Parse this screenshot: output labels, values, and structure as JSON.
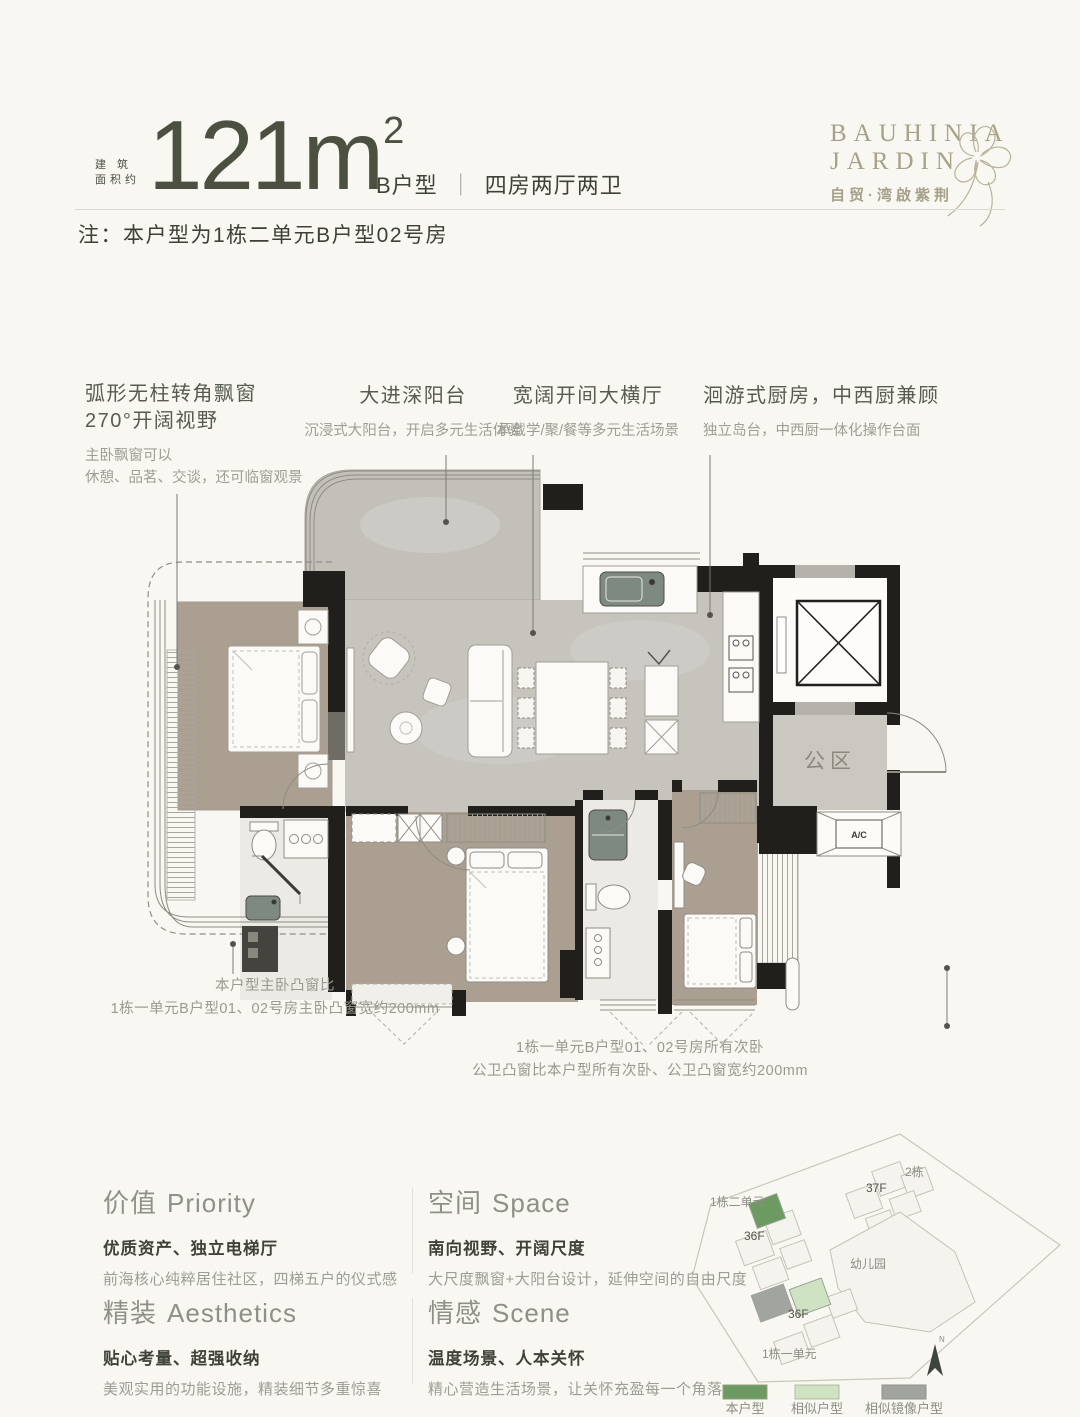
{
  "header": {
    "area_prefix_line1": "建 筑",
    "area_prefix_line2": "面积约",
    "area_value": "121m",
    "area_sup": "2",
    "unit_label": "B户型",
    "unit_divider": "｜",
    "unit_desc": "四房两厅两卫",
    "logo_line1": "BAUHINIA",
    "logo_line2": "JARDIN",
    "logo_cn": "自贸·湾啟紫荆"
  },
  "note": "注：本户型为1栋二单元B户型02号房",
  "callouts": {
    "c1": {
      "title1": "弧形无柱转角飘窗",
      "title2": "270°开阔视野",
      "sub1": "主卧飘窗可以",
      "sub2": "休憩、品茗、交谈，还可临窗观景"
    },
    "c2": {
      "title": "大进深阳台",
      "sub": "沉浸式大阳台，开启多元生活体验"
    },
    "c3": {
      "title": "宽阔开间大横厅",
      "sub": "承载学/聚/餐等多元生活场景"
    },
    "c4": {
      "title": "洄游式厨房，中西厨兼顾",
      "sub": "独立岛台，中西厨一体化操作台面"
    }
  },
  "plan": {
    "public_area_label": "公区",
    "ac_label": "A/C"
  },
  "measure_notes": {
    "left": {
      "line1": "本户型主卧凸窗比",
      "line2": "1栋一单元B户型01、02号房主卧凸窗宽约200mm"
    },
    "mid": {
      "line1": "1栋一单元B户型01、02号房所有次卧",
      "line2": "公卫凸窗比本户型所有次卧、公卫凸窗宽约200mm"
    }
  },
  "features": [
    {
      "title_cn": "价值",
      "title_en": "Priority",
      "subtitle": "优质资产、独立电梯厅",
      "desc": "前海核心纯粹居住社区，四梯五户的仪式感"
    },
    {
      "title_cn": "空间",
      "title_en": "Space",
      "subtitle": "南向视野、开阔尺度",
      "desc": "大尺度飘窗+大阳台设计，延伸空间的自由尺度"
    },
    {
      "title_cn": "精装",
      "title_en": "Aesthetics",
      "subtitle": "贴心考量、超强收纳",
      "desc": "美观实用的功能设施，精装细节多重惊喜"
    },
    {
      "title_cn": "情感",
      "title_en": "Scene",
      "subtitle": "温度场景、人本关怀",
      "desc": "精心营造生活场景，让关怀充盈每一个角落"
    }
  ],
  "siteplan": {
    "labels": {
      "tower1_unit2": "1栋二单元",
      "tower2": "2栋",
      "floors_37": "37F",
      "floors_36a": "36F",
      "kindergarten": "幼儿园",
      "floors_36b": "36F",
      "tower1_unit1": "1栋一单元",
      "north": "N"
    },
    "legend": [
      {
        "label": "本户型",
        "color": "#6d9a60"
      },
      {
        "label": "相似户型",
        "color": "#cfe2c2"
      },
      {
        "label": "相似镜像户型",
        "color": "#a2a49f"
      }
    ]
  },
  "colors": {
    "accent_green": "#6d9a60",
    "text_dark": "#41463a",
    "text_gray": "#9a9d93",
    "logo": "#a7a189"
  }
}
